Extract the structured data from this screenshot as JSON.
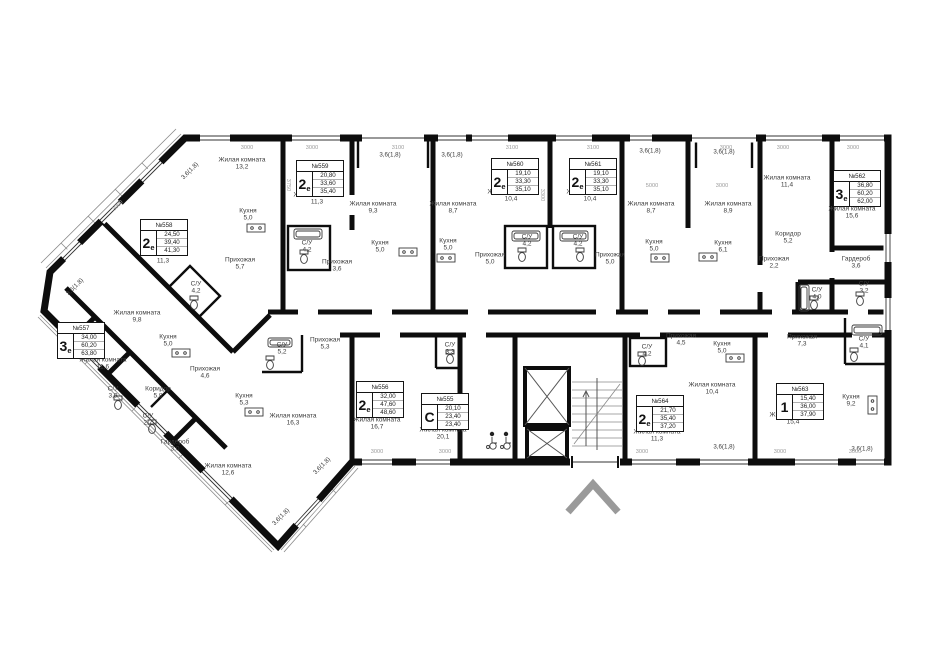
{
  "colors": {
    "wall": "#0d0d0d",
    "dim_text": "#9a9a9a",
    "room_text": "#3c3c3c",
    "entrance_arrow": "#9a9a9a"
  },
  "apartments": [
    {
      "id": "№557",
      "type_big": "3",
      "type_small": "е",
      "area1": "34,00",
      "area2": "60,20",
      "area3": "63,80"
    },
    {
      "id": "№558",
      "type_big": "2",
      "type_small": "е",
      "area1": "24,50",
      "area2": "39,40",
      "area3": "41,30"
    },
    {
      "id": "№559",
      "type_big": "2",
      "type_small": "е",
      "area1": "20,80",
      "area2": "33,60",
      "area3": "35,40"
    },
    {
      "id": "№560",
      "type_big": "2",
      "type_small": "е",
      "area1": "19,10",
      "area2": "33,30",
      "area3": "35,10"
    },
    {
      "id": "№561",
      "type_big": "2",
      "type_small": "е",
      "area1": "19,10",
      "area2": "33,30",
      "area3": "35,10"
    },
    {
      "id": "№562",
      "type_big": "3",
      "type_small": "е",
      "area1": "36,80",
      "area2": "60,20",
      "area3": "62,00"
    },
    {
      "id": "№556",
      "type_big": "2",
      "type_small": "е",
      "area1": "32,00",
      "area2": "47,60",
      "area3": "48,60"
    },
    {
      "id": "№555",
      "type_big": "С",
      "type_small": "",
      "area1": "20,10",
      "area2": "23,40",
      "area3": "23,40"
    },
    {
      "id": "№564",
      "type_big": "2",
      "type_small": "е",
      "area1": "21,70",
      "area2": "35,40",
      "area3": "37,20"
    },
    {
      "id": "№563",
      "type_big": "1",
      "type_small": "",
      "area1": "15,40",
      "area2": "36,00",
      "area3": "37,90"
    }
  ],
  "rooms": [
    {
      "label": "Жилая комната",
      "area": "11,6"
    },
    {
      "label": "Жилая комната",
      "area": "9,8"
    },
    {
      "label": "Кухня",
      "area": "5,0"
    },
    {
      "label": "Прихожая",
      "area": "4,6"
    },
    {
      "label": "Коридор",
      "area": "5,8"
    },
    {
      "label": "С/У",
      "area": "3,9"
    },
    {
      "label": "С/У",
      "area": "2,7"
    },
    {
      "label": "Гардероб",
      "area": "3,0"
    },
    {
      "label": "Жилая комната",
      "area": "12,6"
    },
    {
      "label": "Жилая комната",
      "area": "16,3"
    },
    {
      "label": "Жилая комната",
      "area": "11,3"
    },
    {
      "label": "Жилая комната",
      "area": "13,2"
    },
    {
      "label": "Кухня",
      "area": "5,0"
    },
    {
      "label": "Прихожая",
      "area": "5,7"
    },
    {
      "label": "С/У",
      "area": "4,2"
    },
    {
      "label": "Жилая комната",
      "area": "11,3"
    },
    {
      "label": "Жилая комната",
      "area": "9,3"
    },
    {
      "label": "Кухня",
      "area": "5,0"
    },
    {
      "label": "Прихожая",
      "area": "3,6"
    },
    {
      "label": "С/У",
      "area": "4,2"
    },
    {
      "label": "Жилая комната",
      "area": "10,4"
    },
    {
      "label": "Жилая комната",
      "area": "8,7"
    },
    {
      "label": "Кухня",
      "area": "5,0"
    },
    {
      "label": "Прихожая",
      "area": "5,0"
    },
    {
      "label": "С/У",
      "area": "4,2"
    },
    {
      "label": "Жилая комната",
      "area": "10,4"
    },
    {
      "label": "Жилая комната",
      "area": "8,7"
    },
    {
      "label": "Кухня",
      "area": "5,0"
    },
    {
      "label": "Прихожая",
      "area": "5,0"
    },
    {
      "label": "С/У",
      "area": "4,2"
    },
    {
      "label": "Жилая комната",
      "area": "11,4"
    },
    {
      "label": "Жилая комната",
      "area": "8,9"
    },
    {
      "label": "Жилая комната",
      "area": "15,6"
    },
    {
      "label": "Кухня",
      "area": "6,1"
    },
    {
      "label": "Коридор",
      "area": "5,2"
    },
    {
      "label": "Прихожая",
      "area": "2,2"
    },
    {
      "label": "Гардероб",
      "area": "3,6"
    },
    {
      "label": "С/У",
      "area": "4,0"
    },
    {
      "label": "С/У",
      "area": "3,2"
    },
    {
      "label": "Жилая комната",
      "area": "16,7"
    },
    {
      "label": "Кухня",
      "area": "5,3"
    },
    {
      "label": "Прихожая",
      "area": "5,3"
    },
    {
      "label": "С/У",
      "area": "5,2"
    },
    {
      "label": "Жилая комната",
      "area": "20,1"
    },
    {
      "label": "С/У",
      "area": "3,3"
    },
    {
      "label": "Жилая комната",
      "area": "11,3"
    },
    {
      "label": "Жилая комната",
      "area": "10,4"
    },
    {
      "label": "Кухня",
      "area": "5,0"
    },
    {
      "label": "Прихожая",
      "area": "4,5"
    },
    {
      "label": "С/У",
      "area": "4,2"
    },
    {
      "label": "Жилая комната",
      "area": "15,4"
    },
    {
      "label": "Кухня",
      "area": "9,2"
    },
    {
      "label": "Прихожая",
      "area": "7,3"
    },
    {
      "label": "С/У",
      "area": "4,1"
    }
  ],
  "balconies": [
    "3,6(1,8)",
    "3,6(1,8)",
    "3,6(1,8)",
    "3,6(1,8)",
    "3,6(1,8)",
    "3,6(1,8)",
    "3,6(1,8)",
    "3,6(1,8)",
    "3,6(1,8)",
    "3,6(1,8)"
  ],
  "dimensions": [
    "3000",
    "3000",
    "3100",
    "3100",
    "3100",
    "3000",
    "3000",
    "3000",
    "5000",
    "3000",
    "3000",
    "3000",
    "3000",
    "3000",
    "3000",
    "3000",
    "3460",
    "3750",
    "3300"
  ]
}
